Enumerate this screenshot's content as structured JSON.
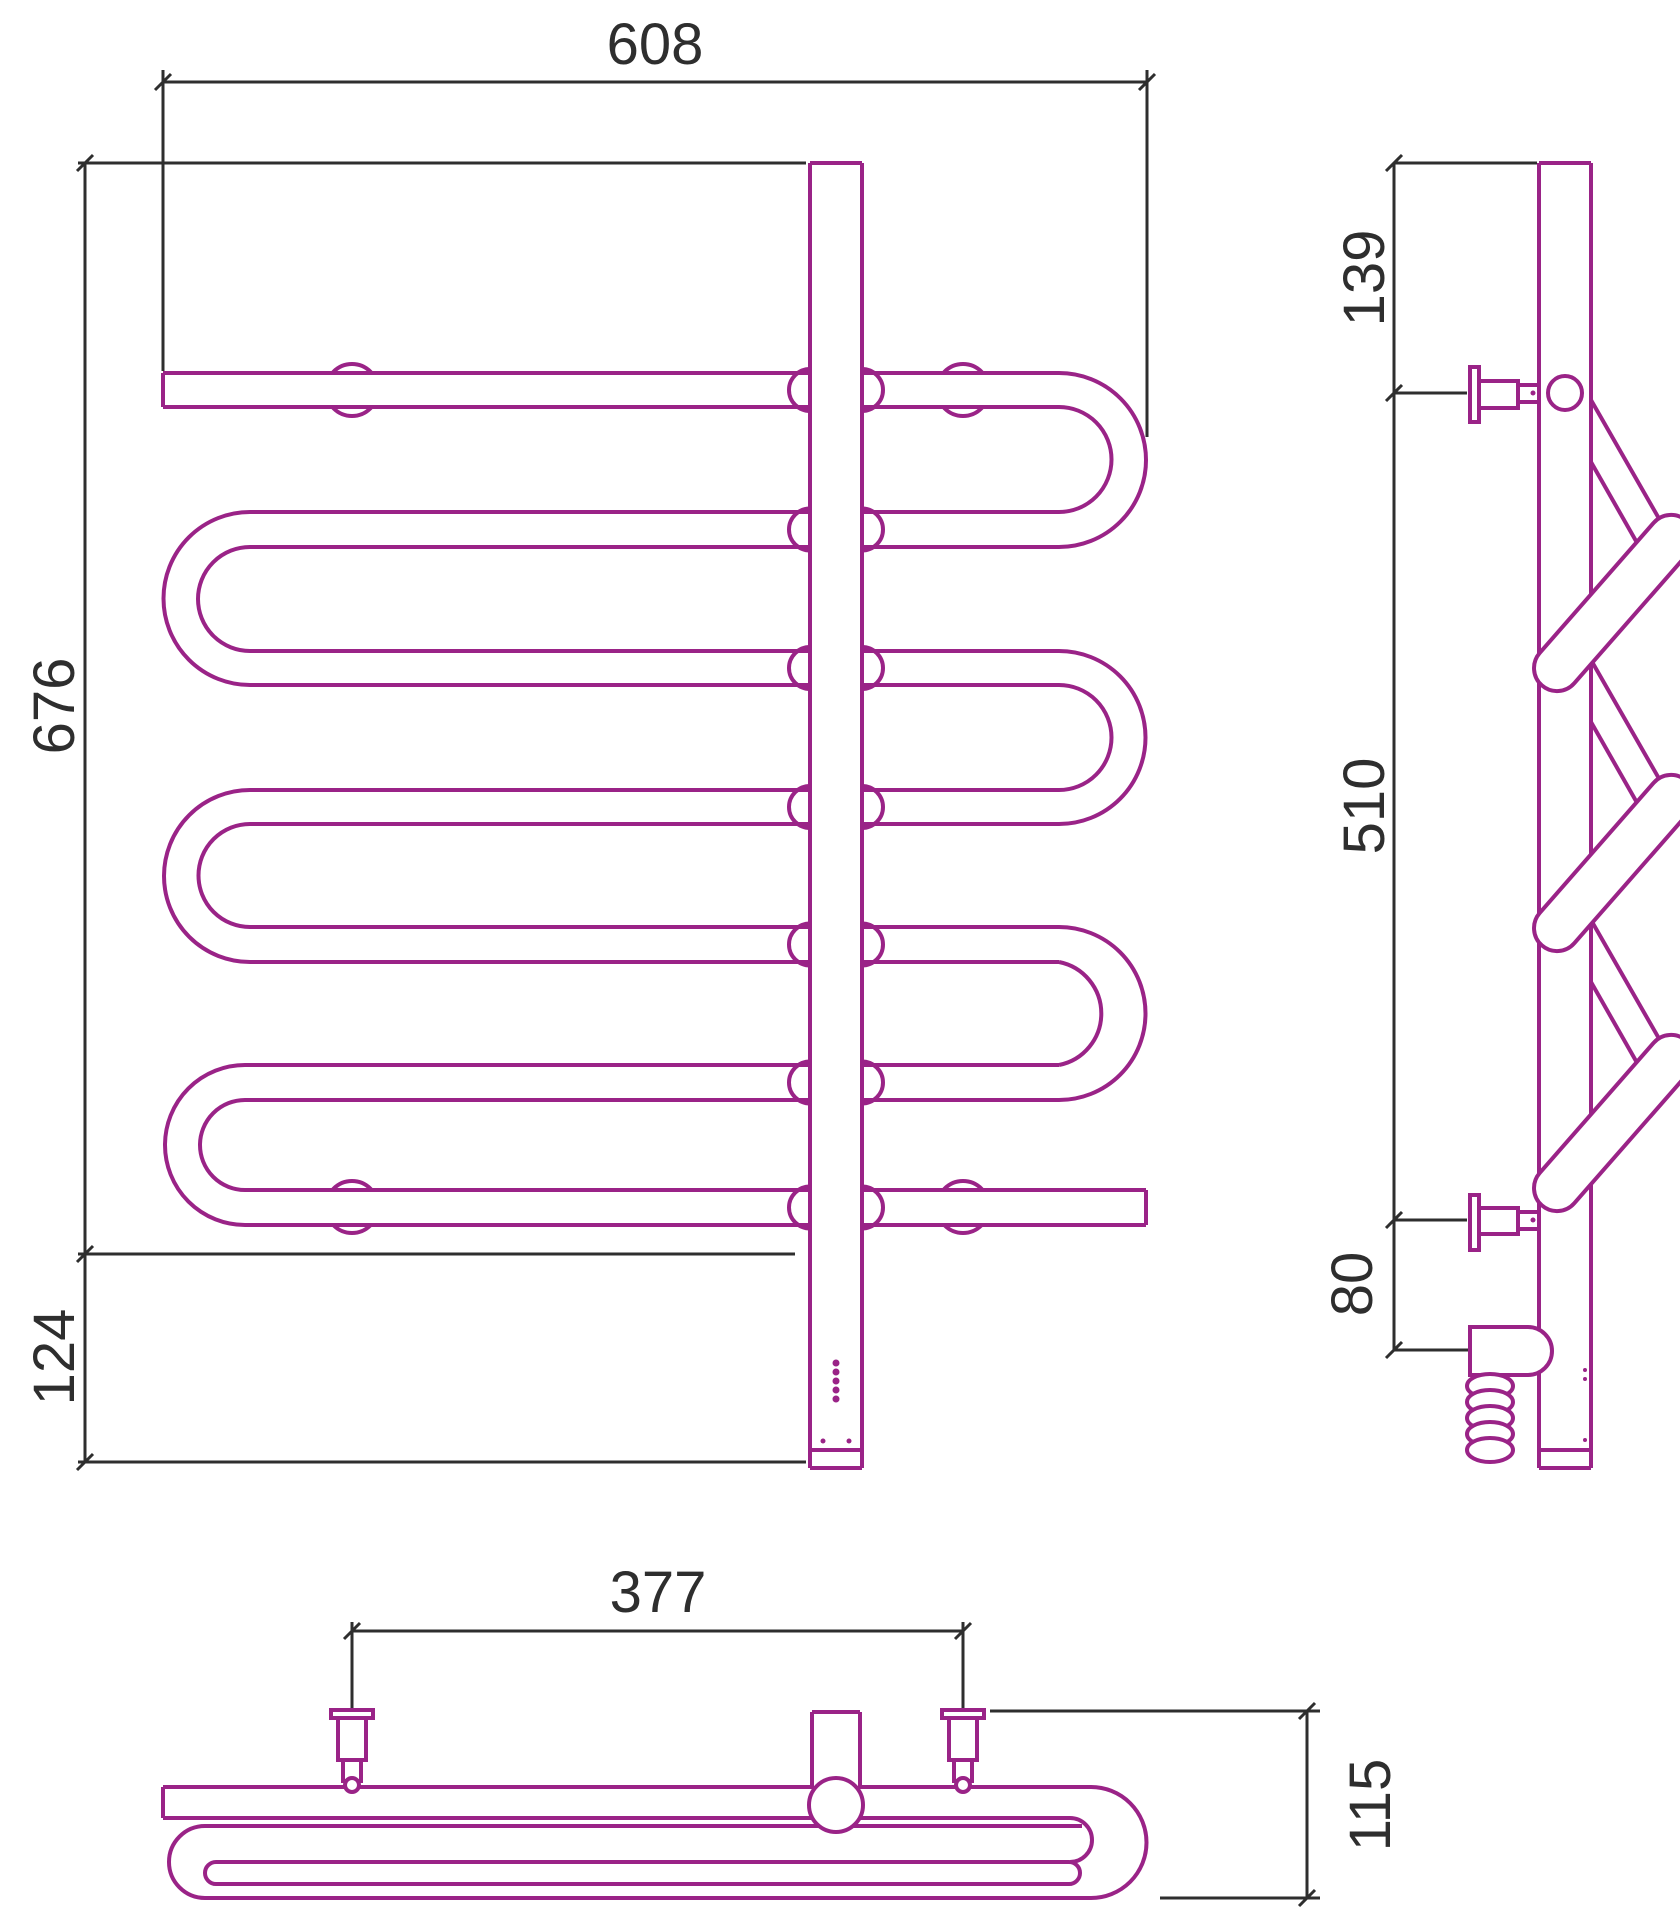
{
  "drawing": {
    "kind": "technical-three-view-drawing",
    "colors": {
      "pipe": "#9a2387",
      "dimension_lines": "#2e2e2e",
      "background": "#ffffff"
    },
    "views": {
      "front": {
        "width": "608",
        "height": "676",
        "lower_extension": "124"
      },
      "side": {
        "top_offset": "139",
        "bracket_span": "510",
        "lower_offset": "80"
      },
      "top": {
        "bracket_span": "377",
        "depth": "115"
      }
    }
  }
}
